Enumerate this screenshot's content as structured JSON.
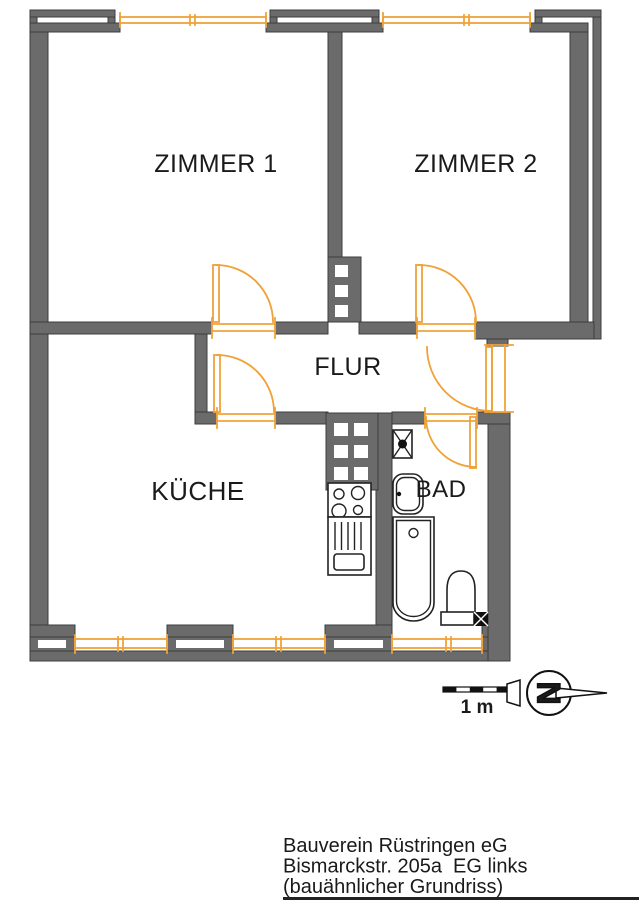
{
  "rooms": {
    "zimmer1": "ZIMMER 1",
    "zimmer2": "ZIMMER 2",
    "flur": "FLUR",
    "kueche": "KÜCHE",
    "bad": "BAD"
  },
  "scale": {
    "label": "1 m"
  },
  "north": {
    "letter": "N"
  },
  "caption": {
    "line1": "Bauverein Rüstringen eG",
    "line2": "Bismarckstr. 205a  EG links",
    "line3": "(bauähnlicher Grundriss)"
  },
  "colors": {
    "wall": "#6b6b6b",
    "wall_outline": "#3c3c3c",
    "accent": "#f0a238",
    "ink": "#1a1a1a",
    "bg": "#ffffff"
  }
}
